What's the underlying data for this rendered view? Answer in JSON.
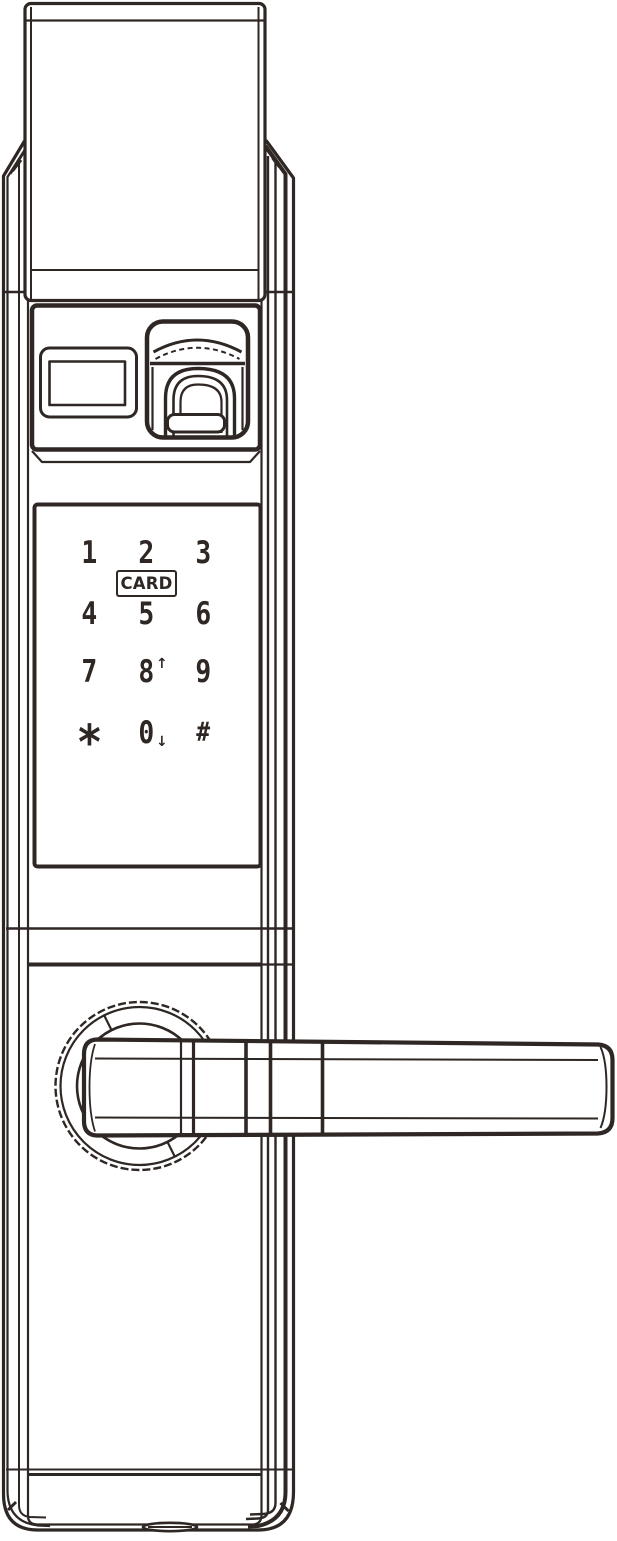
{
  "colors": {
    "ink": "#2e2724",
    "paper": "#ffffff"
  },
  "keypad": {
    "card_label": "CARD",
    "keys": [
      {
        "id": "1",
        "label": "1"
      },
      {
        "id": "2",
        "label": "2"
      },
      {
        "id": "3",
        "label": "3"
      },
      {
        "id": "4",
        "label": "4"
      },
      {
        "id": "5",
        "label": "5"
      },
      {
        "id": "6",
        "label": "6"
      },
      {
        "id": "7",
        "label": "7"
      },
      {
        "id": "8",
        "label": "8",
        "suffix": "↑"
      },
      {
        "id": "9",
        "label": "9"
      },
      {
        "id": "star",
        "label": "*"
      },
      {
        "id": "0",
        "label": "0",
        "suffix": "↓"
      },
      {
        "id": "hash",
        "label": "#"
      }
    ]
  },
  "parts": [
    "top-cover",
    "lock-body",
    "fingerprint-panel",
    "display-window",
    "fingerprint-reader",
    "keypad-panel",
    "card-reader-label",
    "handle-rosette",
    "handle-lever",
    "keyhole-cover"
  ]
}
